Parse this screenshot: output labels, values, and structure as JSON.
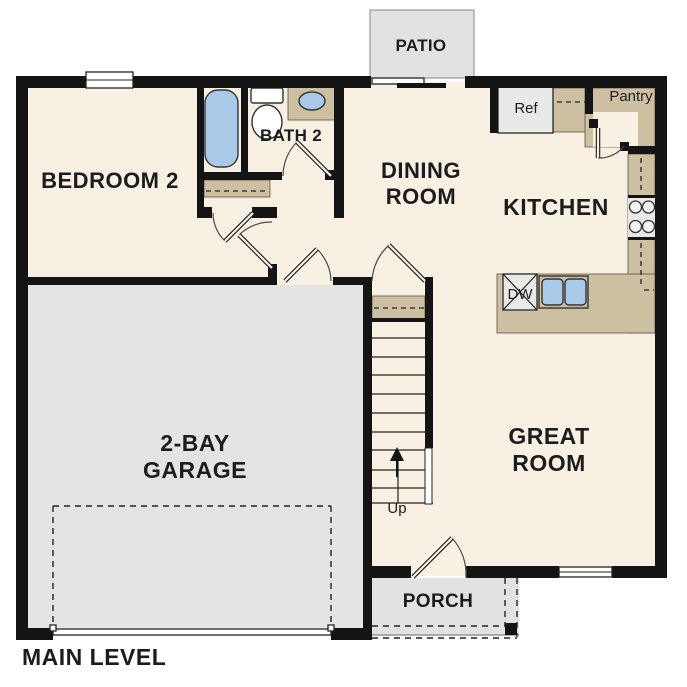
{
  "plan": {
    "title": "MAIN LEVEL",
    "rooms": {
      "bedroom2": "BEDROOM 2",
      "bath2": "BATH 2",
      "dining_line1": "DINING",
      "dining_line2": "ROOM",
      "kitchen": "KITCHEN",
      "great_line1": "GREAT",
      "great_line2": "ROOM",
      "garage_line1": "2-BAY",
      "garage_line2": "GARAGE",
      "patio": "PATIO",
      "porch": "PORCH",
      "pantry": "Pantry"
    },
    "fixtures": {
      "refrigerator": "Ref",
      "dishwasher": "DW",
      "stairs_up": "Up"
    },
    "colors": {
      "floor": "#f7f0e3",
      "garage_floor": "#e4e4e2",
      "outdoor_gray": "#e2e2e0",
      "counter_tan": "#cdbfa2",
      "fixture_blue": "#a9c9e9",
      "appliance_gray": "#e9e9e7",
      "wall_black": "#141414"
    }
  }
}
